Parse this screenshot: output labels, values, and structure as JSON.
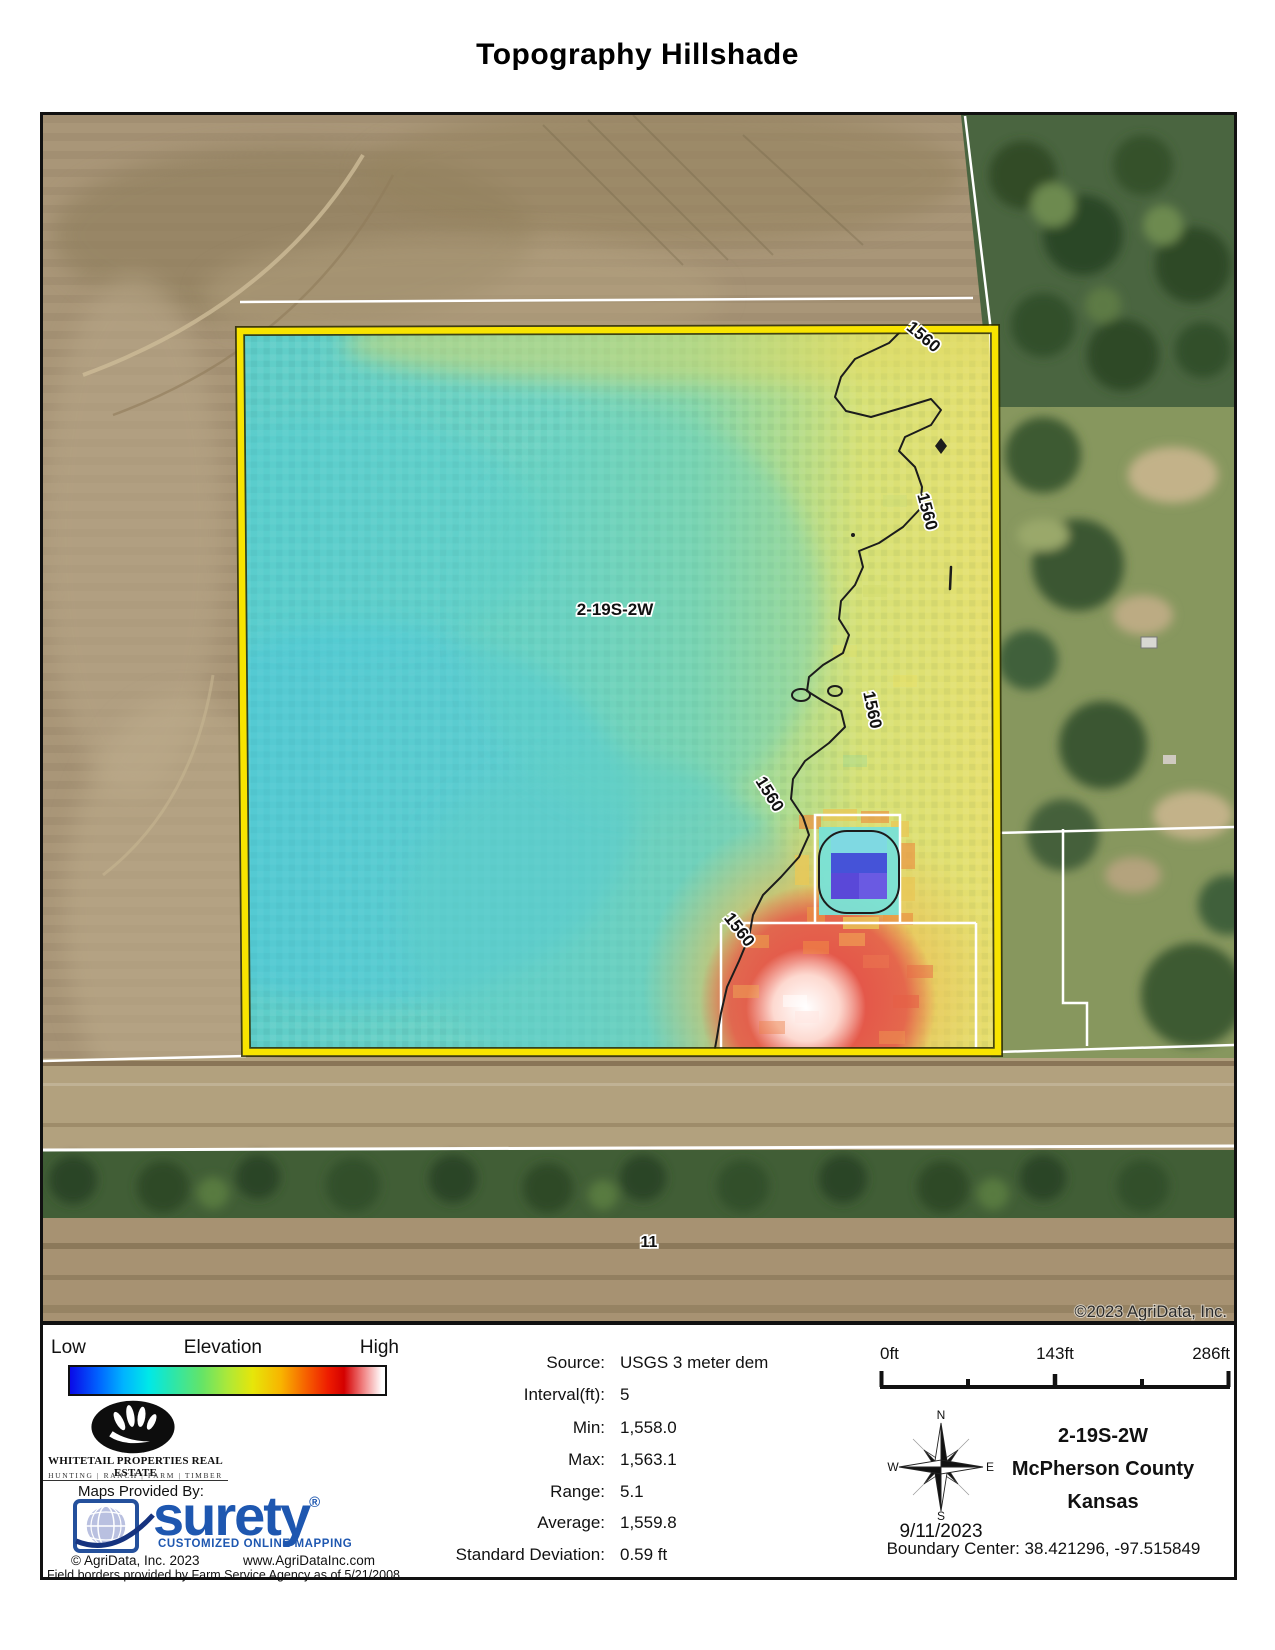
{
  "title": "Topography Hillshade",
  "map": {
    "parcel_label": "2-19S-2W",
    "contour_label": "1560",
    "road_label": "11",
    "copyright": "©2023 AgriData, Inc."
  },
  "legend": {
    "low": "Low",
    "title": "Elevation",
    "high": "High",
    "gradient_stops": [
      "#0a0ae8",
      "#0063ff",
      "#00b4ff",
      "#00e8e8",
      "#2ee6a8",
      "#66e466",
      "#ace839",
      "#e6e60a",
      "#f8b400",
      "#f66000",
      "#ee1c00",
      "#d40000",
      "#f08080",
      "#ffffff"
    ]
  },
  "branding": {
    "whitetail_name": "WHITETAIL PROPERTIES REAL ESTATE",
    "whitetail_tagline": "HUNTING | RANCH | FARM | TIMBER",
    "maps_provided_by": "Maps Provided By:",
    "surety_name": "surety",
    "surety_reg": "®",
    "surety_tagline": "CUSTOMIZED ONLINE MAPPING",
    "agridata_copyright": "© AgriData, Inc. 2023",
    "agridata_url": "www.AgriDataInc.com",
    "field_borders_note": "Field borders provided by Farm Service Agency as of 5/21/2008."
  },
  "stats": {
    "rows": [
      {
        "label": "Source:",
        "value": "USGS 3 meter dem"
      },
      {
        "label": "Interval(ft):",
        "value": "5"
      },
      {
        "label": "Min:",
        "value": "1,558.0"
      },
      {
        "label": "Max:",
        "value": "1,563.1"
      },
      {
        "label": "Range:",
        "value": "5.1"
      },
      {
        "label": "Average:",
        "value": "1,559.8"
      },
      {
        "label": "Standard Deviation:",
        "value": "0.59 ft"
      }
    ]
  },
  "scalebar": {
    "labels": [
      "0ft",
      "143ft",
      "286ft"
    ]
  },
  "compass": {
    "n": "N",
    "e": "E",
    "s": "S",
    "w": "W",
    "date": "9/11/2023"
  },
  "location": {
    "township": "2-19S-2W",
    "county": "McPherson County",
    "state": "Kansas",
    "boundary_center": "Boundary Center: 38.421296, -97.515849"
  },
  "colors": {
    "boundary_yellow": "#f8e400",
    "contour_black": "#1c1c1c",
    "parcel_line_white": "#ffffff",
    "surety_blue": "#1e57b0",
    "elevation_low": "#0a0ae8",
    "elevation_high": "#ffffff",
    "field_cyan": "#6ed2bf",
    "field_yellow": "#e6df6e",
    "hotspot_red": "#e4584a"
  }
}
